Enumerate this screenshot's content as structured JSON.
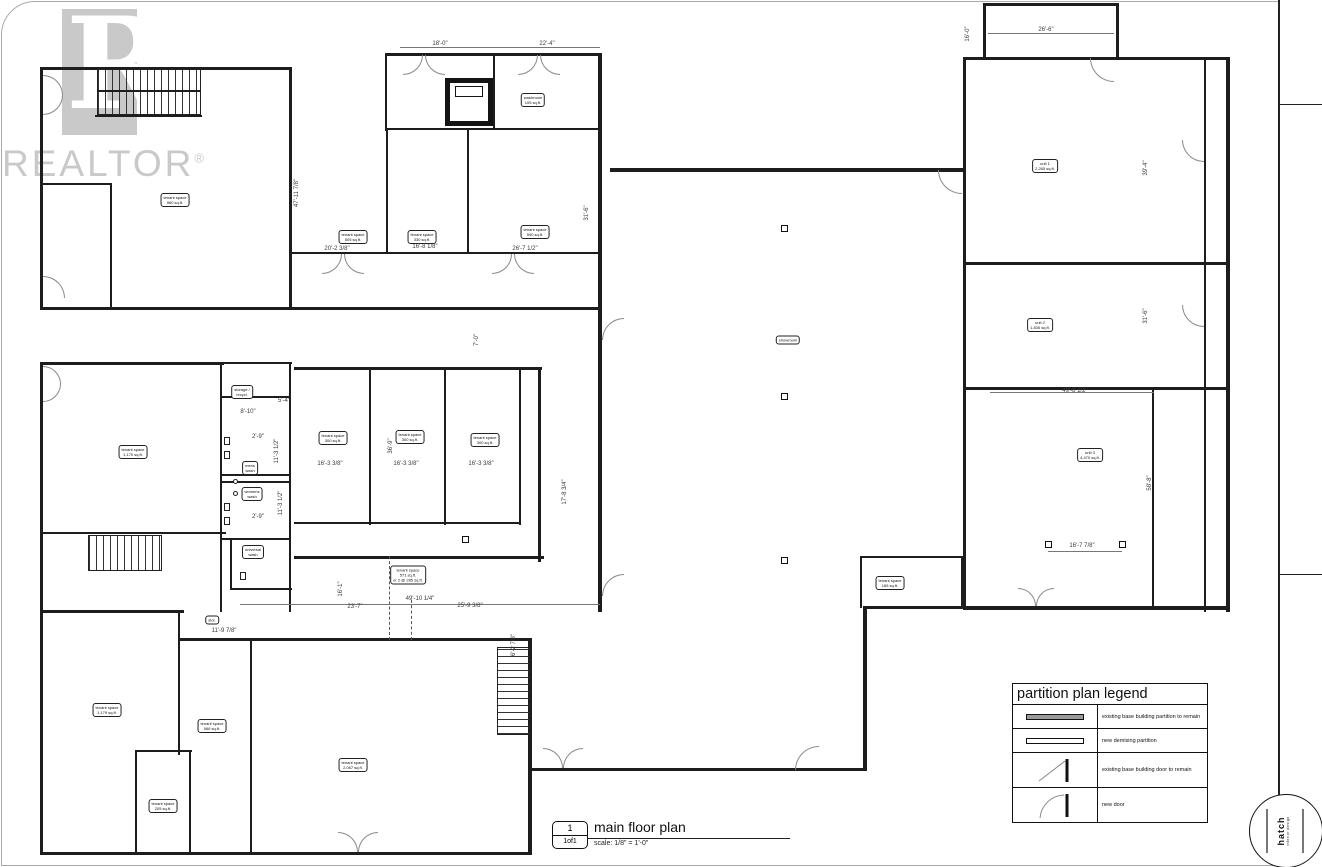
{
  "watermark": {
    "brand": "REALTOR",
    "reg": "®"
  },
  "title_block": {
    "sheet_no_value": "1of1",
    "sheet_no_label": "sheet no.",
    "notes": [
      "· do not scale from drawings",
      "· site verify all dimensions and information",
      "· report any errors or discrepancies",
      "· all work to conform to applicable codes & regulations",
      "· drawings are published by hatch interior design - all rights reserved including rights of reproduction"
    ],
    "date_label": "date",
    "date_value": "June 3, 2020",
    "scale_label": "scale",
    "scale_value": "as noted",
    "drawn_label": "drawn by",
    "drawn_value": "e/ss",
    "sheet_title": "floor plan",
    "project_name": "lakewood mall",
    "address_line1": "11823 hwy-97, lake country",
    "address_line2": "bc v4v 1e3",
    "stamp_name": "hatch",
    "stamp_sub": "interior design"
  },
  "legend": {
    "title": "partition plan legend",
    "items": [
      {
        "symbol": "existing-partition",
        "label": "existing base building partition to remain"
      },
      {
        "symbol": "new-demising-partition",
        "label": "new demising partition"
      },
      {
        "symbol": "existing-door",
        "label": "existing base building door to remain"
      },
      {
        "symbol": "new-door",
        "label": "new door"
      }
    ]
  },
  "drawing_title": {
    "number": "1",
    "sheet": "1of1",
    "title": "main floor plan",
    "scale": "scale: 1/8\" = 1'-0\""
  },
  "plan": {
    "rooms": [
      {
        "x": 175,
        "y": 200,
        "text": "tenant space\n960 sq.ft."
      },
      {
        "x": 353,
        "y": 237,
        "text": "tenant space\n505 sq.ft."
      },
      {
        "x": 422,
        "y": 237,
        "text": "tenant space\n330 sq.ft."
      },
      {
        "x": 535,
        "y": 232,
        "text": "tenant space\n590 sq.ft."
      },
      {
        "x": 533,
        "y": 100,
        "text": "washroom\n105 sq.ft."
      },
      {
        "x": 133,
        "y": 452,
        "text": "tenant space\n1,170 sq.ft."
      },
      {
        "x": 242,
        "y": 392,
        "text": "storage /\nrecycl."
      },
      {
        "x": 250,
        "y": 468,
        "text": "mens\nwash"
      },
      {
        "x": 252,
        "y": 494,
        "text": "womens\nwash"
      },
      {
        "x": 253,
        "y": 552,
        "text": "universal\nwash"
      },
      {
        "x": 333,
        "y": 438,
        "text": "tenant space\n300 sq.ft."
      },
      {
        "x": 410,
        "y": 437,
        "text": "tenant space\n300 sq.ft."
      },
      {
        "x": 485,
        "y": 440,
        "text": "tenant space\n300 sq.ft."
      },
      {
        "x": 408,
        "y": 575,
        "text": "tenant space\n571 sq.ft.\nor 2 @ 285 sq.ft."
      },
      {
        "x": 788,
        "y": 340,
        "text": "showroom"
      },
      {
        "x": 1045,
        "y": 166,
        "text": "unit 1\n2,265 sq.ft."
      },
      {
        "x": 1040,
        "y": 325,
        "text": "unit 2\n1,835 sq.ft."
      },
      {
        "x": 1090,
        "y": 455,
        "text": "unit 3\n4,470 sq.ft."
      },
      {
        "x": 890,
        "y": 583,
        "text": "tenant space\n165 sq.ft."
      },
      {
        "x": 107,
        "y": 710,
        "text": "tenant space\n1,179 sq.ft."
      },
      {
        "x": 212,
        "y": 726,
        "text": "tenant space\n566 sq.ft."
      },
      {
        "x": 163,
        "y": 806,
        "text": "tenant space\n205 sq.ft."
      },
      {
        "x": 353,
        "y": 765,
        "text": "tenant space\n2,067 sq.ft."
      },
      {
        "x": 212,
        "y": 620,
        "text": "stor."
      }
    ],
    "dims": [
      {
        "t": "18'-0\"",
        "x": 440,
        "y": 44
      },
      {
        "t": "22'-4\"",
        "x": 547,
        "y": 44
      },
      {
        "t": "26'-6\"",
        "x": 1046,
        "y": 30
      },
      {
        "t": "16'-0\"",
        "x": 968,
        "y": 34,
        "v": true
      },
      {
        "t": "47'-11 7/8\"",
        "x": 297,
        "y": 193,
        "v": true
      },
      {
        "t": "31'-6\"",
        "x": 587,
        "y": 213,
        "v": true
      },
      {
        "t": "20'-2 3/8\"",
        "x": 337,
        "y": 249
      },
      {
        "t": "16'-8 1/8\"",
        "x": 425,
        "y": 247
      },
      {
        "t": "26'-7 1/2\"",
        "x": 525,
        "y": 249
      },
      {
        "t": "7'-0\"",
        "x": 477,
        "y": 340,
        "v": true
      },
      {
        "t": "5'-4\"",
        "x": 284,
        "y": 401
      },
      {
        "t": "8'-10\"",
        "x": 248,
        "y": 412
      },
      {
        "t": "2'-9\"",
        "x": 258,
        "y": 437
      },
      {
        "t": "11'-3 1/2\"",
        "x": 277,
        "y": 451,
        "v": true
      },
      {
        "t": "11'-3 1/2\"",
        "x": 281,
        "y": 503,
        "v": true
      },
      {
        "t": "2'-9\"",
        "x": 258,
        "y": 517
      },
      {
        "t": "36'-9\"",
        "x": 391,
        "y": 446,
        "v": true
      },
      {
        "t": "16'-3 3/8\"",
        "x": 330,
        "y": 464
      },
      {
        "t": "16'-3 3/8\"",
        "x": 406,
        "y": 464
      },
      {
        "t": "16'-3 3/8\"",
        "x": 481,
        "y": 464
      },
      {
        "t": "17'-8 3/4\"",
        "x": 565,
        "y": 492,
        "v": true
      },
      {
        "t": "16'-1\"",
        "x": 341,
        "y": 589,
        "v": true
      },
      {
        "t": "23'-7\"",
        "x": 355,
        "y": 607
      },
      {
        "t": "49'-10 1/4\"",
        "x": 420,
        "y": 599
      },
      {
        "t": "25'-9 3/8\"",
        "x": 470,
        "y": 606
      },
      {
        "t": "11'-9 7/8\"",
        "x": 224,
        "y": 631
      },
      {
        "t": "6'-2 7/8\"",
        "x": 514,
        "y": 645,
        "v": true
      },
      {
        "t": "49'-8 1/2\"",
        "x": 1075,
        "y": 391
      },
      {
        "t": "16'-7 7/8\"",
        "x": 1082,
        "y": 546
      },
      {
        "t": "39'-4\"",
        "x": 1146,
        "y": 168,
        "v": true
      },
      {
        "t": "31'-6\"",
        "x": 1146,
        "y": 316,
        "v": true
      },
      {
        "t": "58'-8\"",
        "x": 1150,
        "y": 483,
        "v": true
      }
    ]
  }
}
